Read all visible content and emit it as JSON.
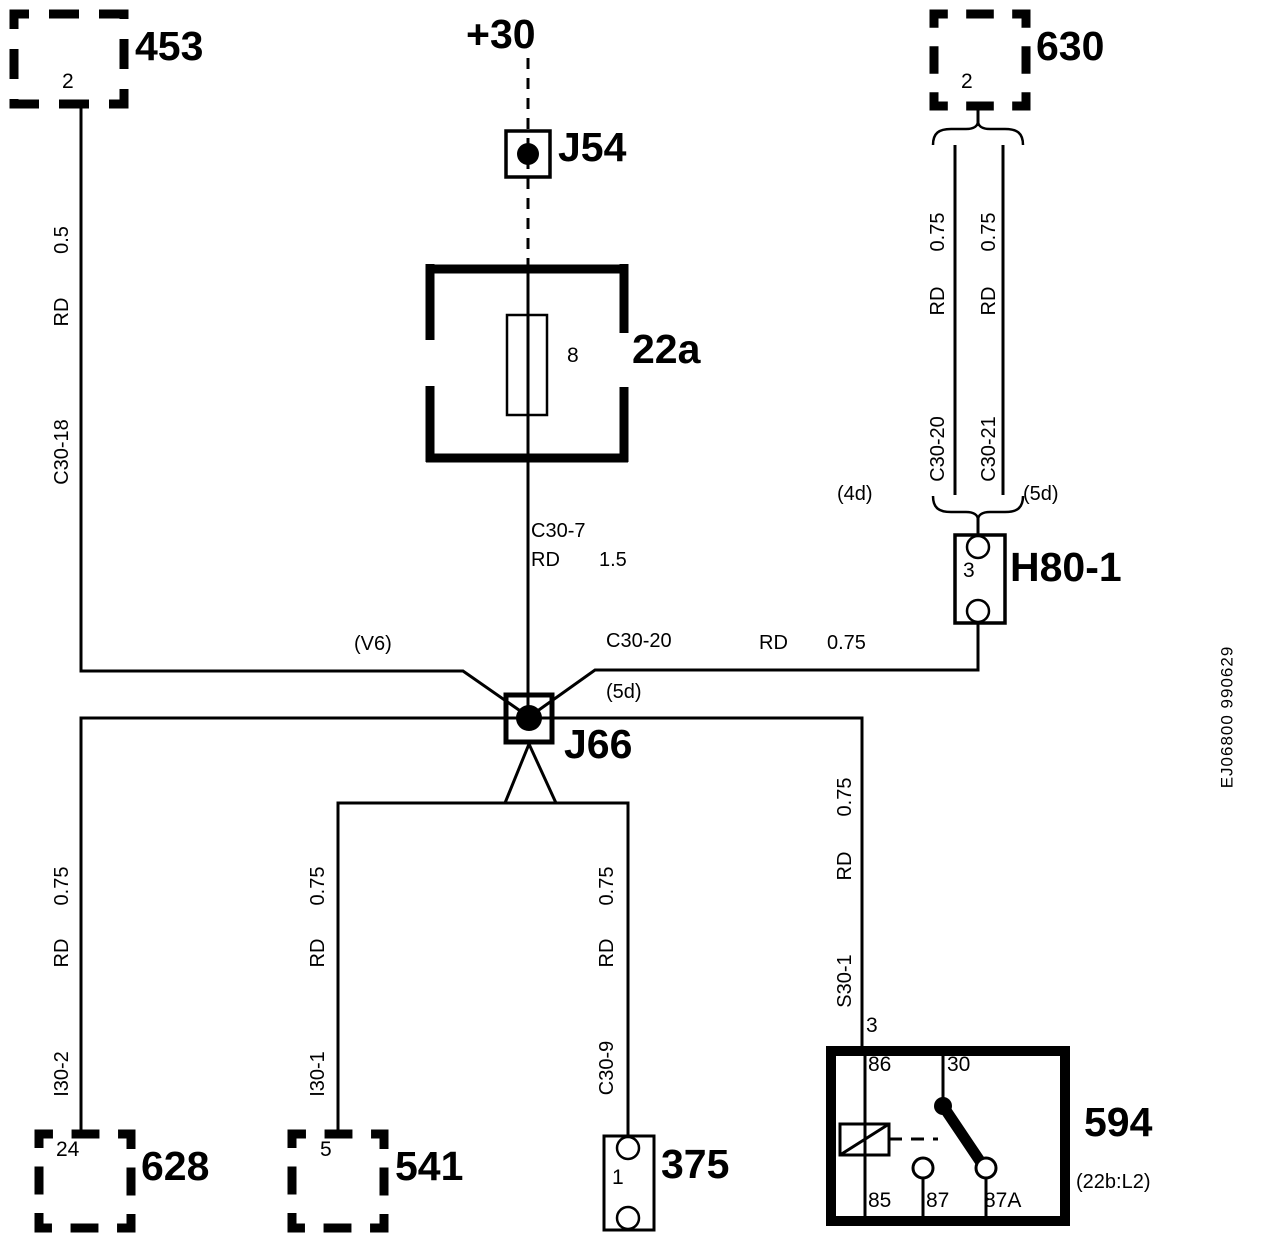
{
  "power_label": "+30",
  "doc_ref": "EJ06800 990629",
  "components": {
    "box453": {
      "id": "453",
      "pin": "2"
    },
    "box630": {
      "id": "630",
      "pin": "2"
    },
    "j54": {
      "id": "J54"
    },
    "fuse22a": {
      "id": "22a",
      "fuse_no": "8"
    },
    "h80": {
      "id": "H80-1",
      "pin": "3"
    },
    "j66": {
      "id": "J66"
    },
    "box628": {
      "id": "628",
      "pin": "24"
    },
    "box541": {
      "id": "541",
      "pin": "5"
    },
    "box375": {
      "id": "375",
      "pin": "1"
    },
    "relay594": {
      "id": "594",
      "ref": "(22b:L2)",
      "pin_top": "3",
      "pin86": "86",
      "pin30": "30",
      "pin85": "85",
      "pin87": "87",
      "pin87a": "87A"
    }
  },
  "wires": {
    "from453": {
      "size": "0.5",
      "color": "RD",
      "code": "C30-18"
    },
    "fuse_out": {
      "code": "C30-7",
      "color": "RD",
      "size": "1.5"
    },
    "pair630_left": {
      "size": "0.75",
      "color": "RD",
      "code": "C30-20"
    },
    "pair630_right": {
      "size": "0.75",
      "color": "RD",
      "code": "C30-21"
    },
    "h80_to_j66": {
      "code": "C30-20",
      "color": "RD",
      "size": "0.75"
    },
    "to628": {
      "size": "0.75",
      "color": "RD",
      "code": "I30-2"
    },
    "to541": {
      "size": "0.75",
      "color": "RD",
      "code": "I30-1"
    },
    "to375": {
      "size": "0.75",
      "color": "RD",
      "code": "C30-9"
    },
    "to594": {
      "size": "0.75",
      "color": "RD",
      "code": "S30-1"
    }
  },
  "refs": {
    "v6": "(V6)",
    "d5_at_j66": "(5d)",
    "d4": "(4d)",
    "d5": "(5d)"
  },
  "colors": {
    "ink": "#000000",
    "paper": "#ffffff"
  }
}
